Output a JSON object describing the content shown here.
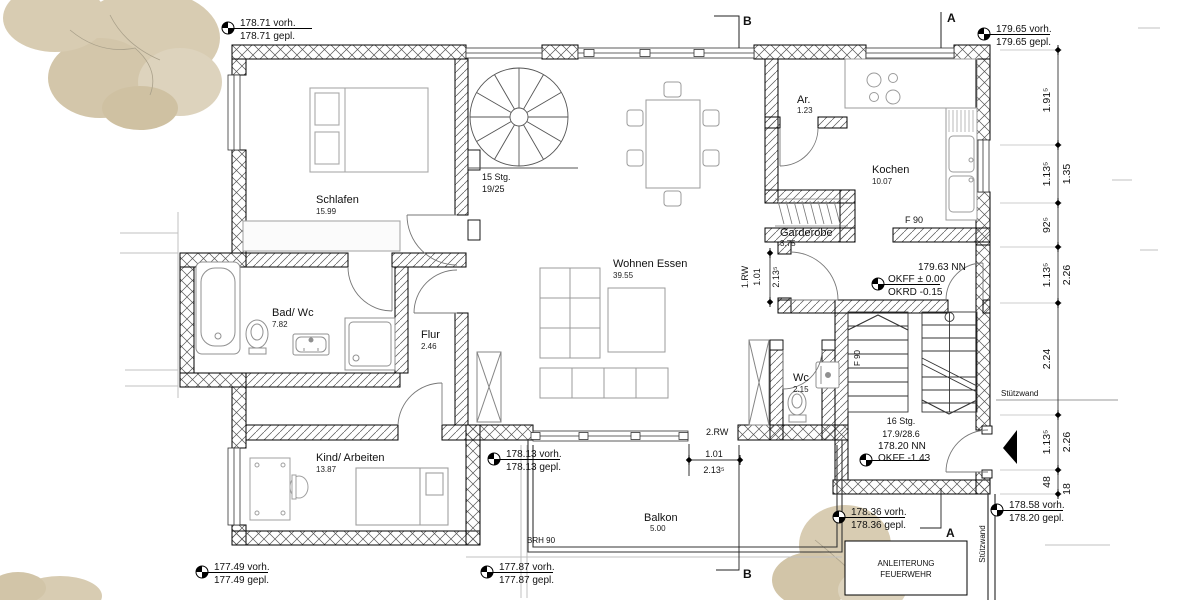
{
  "rooms": {
    "schlafen": {
      "name": "Schlafen",
      "area": "15.99"
    },
    "bad": {
      "name": "Bad/ Wc",
      "area": "7.82"
    },
    "kind": {
      "name": "Kind/ Arbeiten",
      "area": "13.87"
    },
    "flur": {
      "name": "Flur",
      "area": "2.46"
    },
    "wohnen": {
      "name": "Wohnen Essen",
      "area": "39.55"
    },
    "kochen": {
      "name": "Kochen",
      "area": "10.07"
    },
    "ar": {
      "name": "Ar.",
      "area": "1.23"
    },
    "garderobe": {
      "name": "Garderobe",
      "area": "3.75"
    },
    "wc": {
      "name": "Wc",
      "area": "2.15"
    },
    "balkon": {
      "name": "Balkon",
      "area": "5.00"
    }
  },
  "stairs": {
    "spiral_l1": "15 Stg.",
    "spiral_l2": "19/25",
    "main_l1": "16 Stg.",
    "main_l2": "17.9/28.6"
  },
  "levels": {
    "tl1": "178.71 vorh.",
    "tl2": "178.71 gepl.",
    "tr1": "179.65 vorh.",
    "tr2": "179.65 gepl.",
    "bl1": "177.49 vorh.",
    "bl2": "177.49 gepl.",
    "bm1": "177.87 vorh.",
    "bm2": "177.87 gepl.",
    "terr1": "178.13 vorh.",
    "terr2": "178.13 gepl.",
    "br1a": "178.36 vorh.",
    "br1b": "178.36 gepl.",
    "br2a": "178.58 vorh.",
    "br2b": "178.20 gepl.",
    "mid1": "179.63 NN",
    "mid2": "OKFF ± 0.00",
    "mid3": "OKRD -0.15",
    "entry1": "178.20 NN",
    "entry2": "OKFF -1.43"
  },
  "openings": {
    "rw1_label": "1.RW",
    "rw1_w": "1.01",
    "rw1_h": "2.13⁵",
    "rw2_label": "2.RW",
    "rw2_w": "1.01",
    "rw2_h": "2.13⁵"
  },
  "dims_right": {
    "inner": [
      "1.91⁵",
      "1.13⁵",
      "92⁵",
      "1.13⁵",
      "2.24",
      "1.13⁵",
      "48"
    ],
    "outer": [
      "1.35",
      "2.26",
      "2.26",
      "18"
    ]
  },
  "annotations": {
    "f90_kitchen": "F 90",
    "f90_stair": "F 90",
    "brh": "BRH 90",
    "stuetzwand_top": "Stützwand",
    "stuetzwand_bottom": "Stützwand",
    "fire_line1": "ANLEITERUNG",
    "fire_line2": "FEUERWEHR",
    "section_a": "A",
    "section_b": "B"
  }
}
